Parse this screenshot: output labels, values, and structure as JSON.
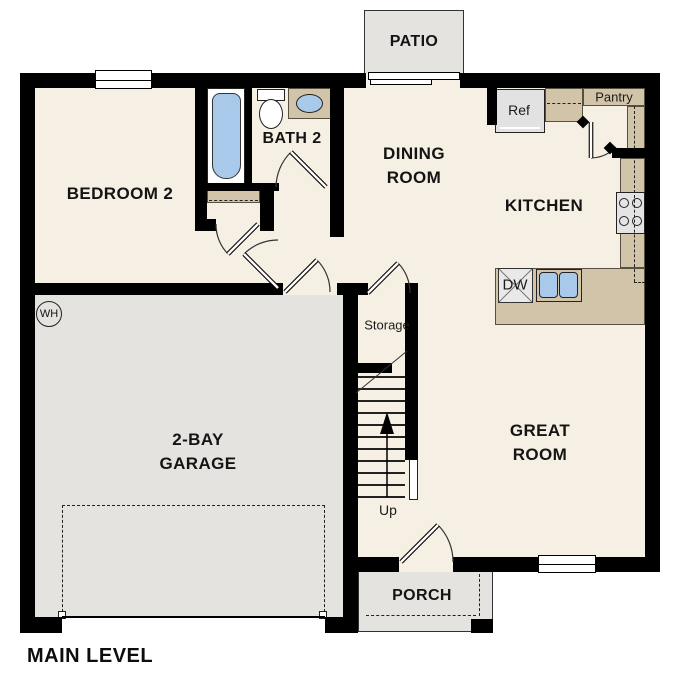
{
  "plan": {
    "title": "MAIN LEVEL",
    "rooms": {
      "patio": "PATIO",
      "bedroom2": "BEDROOM 2",
      "bath2": "BATH 2",
      "dining_line1": "DINING",
      "dining_line2": "ROOM",
      "kitchen": "KITCHEN",
      "great_line1": "GREAT",
      "great_line2": "ROOM",
      "garage_line1": "2-BAY",
      "garage_line2": "GARAGE",
      "porch": "PORCH"
    },
    "labels": {
      "ref": "Ref",
      "pantry": "Pantry",
      "storage": "Storage",
      "dw": "DW",
      "wh": "WH",
      "up": "Up"
    },
    "colors": {
      "wall": "#000000",
      "floor": "#f6efe3",
      "garage_floor": "#e4e3df",
      "counter_tan": "#d2c4a9",
      "fixture_blue": "#a9c9eb",
      "appliance_gray": "#e2e2e2"
    }
  }
}
